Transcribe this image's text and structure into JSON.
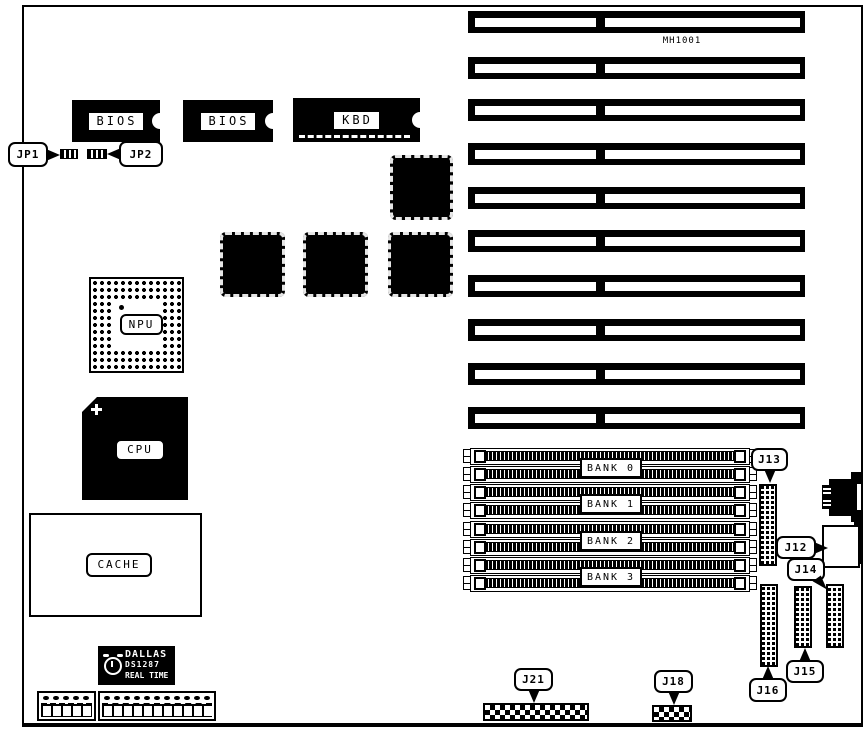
{
  "figure": {
    "model_number": "MH1001"
  },
  "chips": {
    "bios1": "BIOS",
    "bios2": "BIOS",
    "kbd": "KBD",
    "npu": "NPU",
    "cpu": "CPU",
    "cache": "CACHE"
  },
  "rtc": {
    "brand": "DALLAS",
    "model": "DS1287",
    "tagline": "REAL TIME"
  },
  "jumpers": {
    "jp1": "JP1",
    "jp2": "JP2"
  },
  "connectors": {
    "j12": "J12",
    "j13": "J13",
    "j14": "J14",
    "j15": "J15",
    "j16": "J16",
    "j18": "J18",
    "j21": "J21"
  },
  "banks": [
    "BANK 0",
    "BANK 1",
    "BANK 2",
    "BANK 3"
  ],
  "counts": {
    "isa_slots": 10,
    "simm_slots": 8
  },
  "colors": {
    "ink": "#000000",
    "paper": "#ffffff"
  }
}
